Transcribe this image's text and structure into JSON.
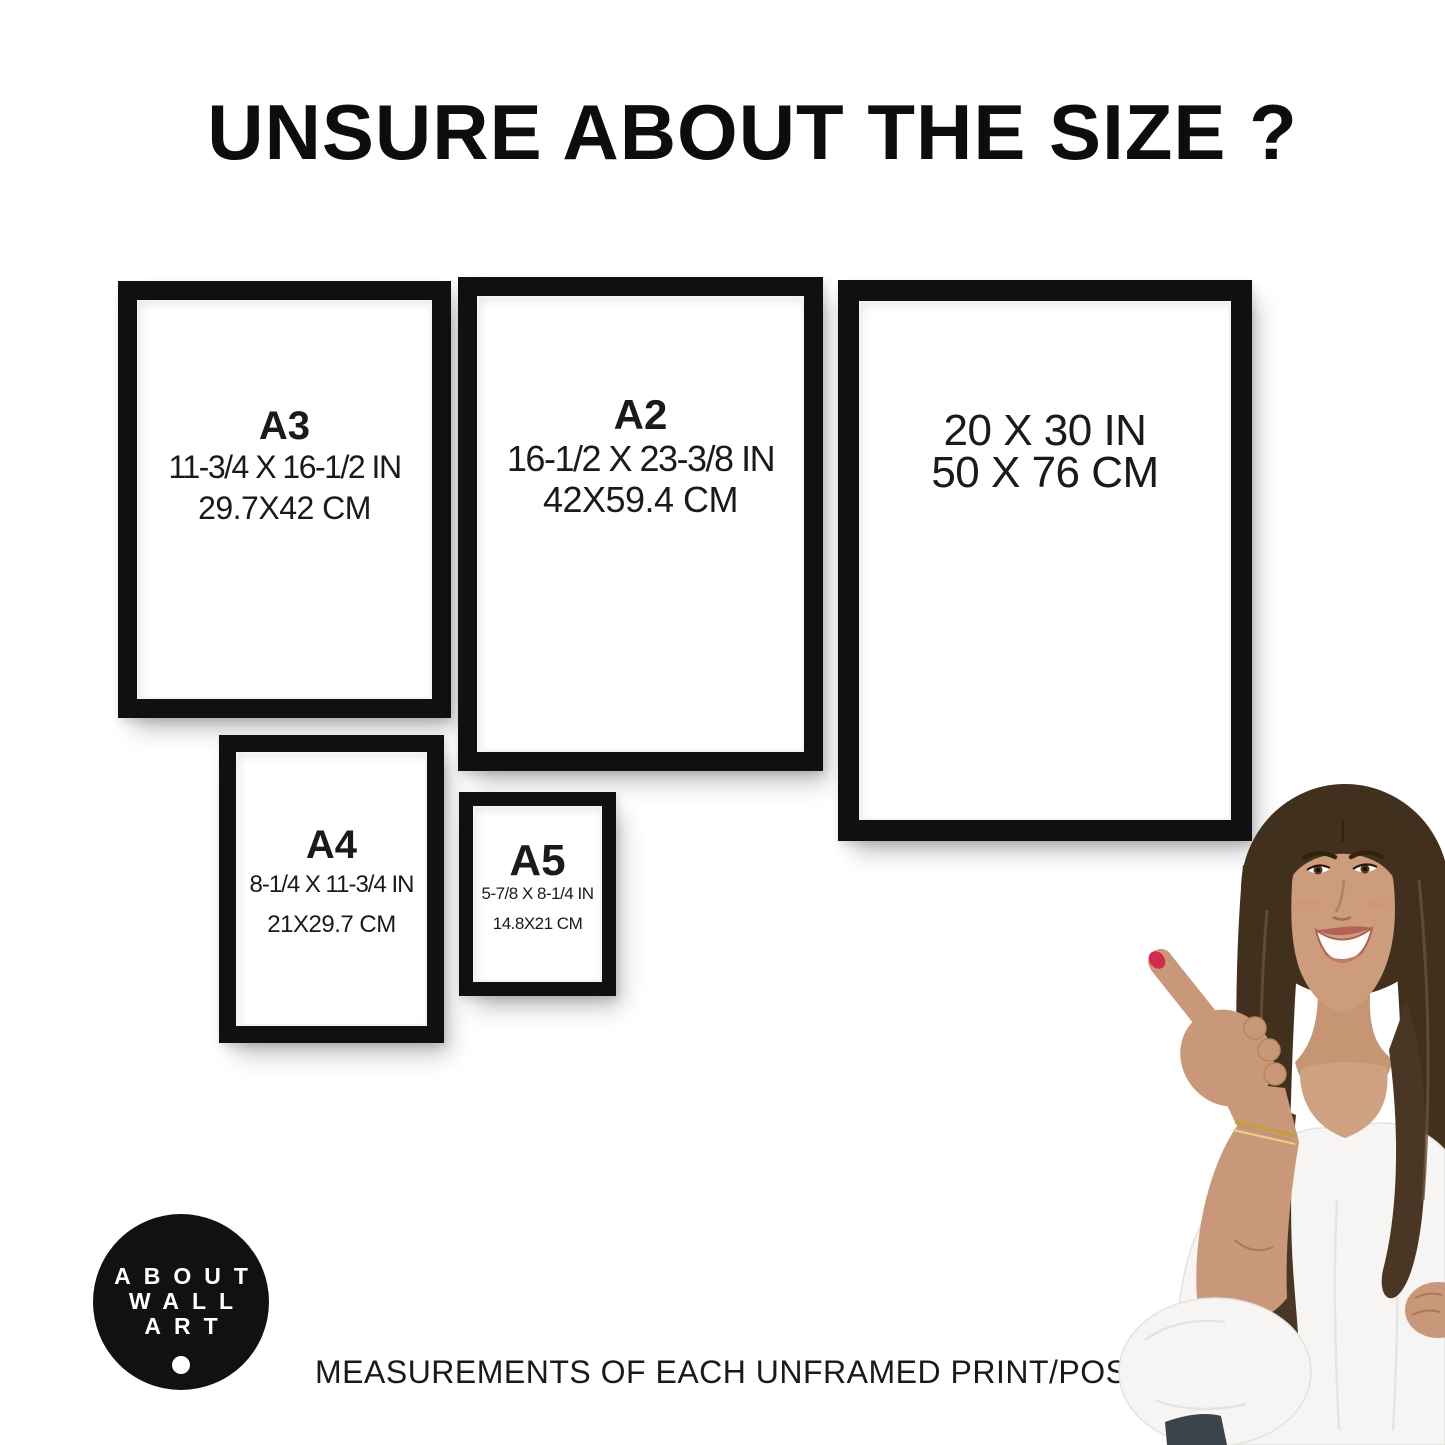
{
  "page": {
    "title": "UNSURE ABOUT THE SIZE ?",
    "caption": "MEASUREMENTS OF EACH UNFRAMED PRINT/POSTER"
  },
  "frames": [
    {
      "id": "a3",
      "label": "A3",
      "inches": "11-3/4 X 16-1/2 IN",
      "cm": "29.7X42 CM"
    },
    {
      "id": "a2",
      "label": "A2",
      "inches": "16-1/2 X 23-3/8 IN",
      "cm": "42X59.4 CM"
    },
    {
      "id": "20x30",
      "label": "",
      "inches": "20 X 30 IN",
      "cm": "50 X 76 CM"
    },
    {
      "id": "a4",
      "label": "A4",
      "inches": "8-1/4 X 11-3/4 IN",
      "cm": "21X29.7 CM"
    },
    {
      "id": "a5",
      "label": "A5",
      "inches": "5-7/8 X 8-1/4 IN",
      "cm": "14.8X21 CM"
    }
  ],
  "logo": {
    "line1": "ABOUT",
    "line2": "WALL",
    "line3": "ART"
  },
  "palette": {
    "background": "#ffffff",
    "frame_black": "#101010",
    "text_black": "#1a1a1a",
    "logo_black": "#111111",
    "nail_red": "#d32b50",
    "hair_brown": "#42301f",
    "skin_tan": "#c9987a",
    "blouse_white": "#f6f5f3"
  }
}
